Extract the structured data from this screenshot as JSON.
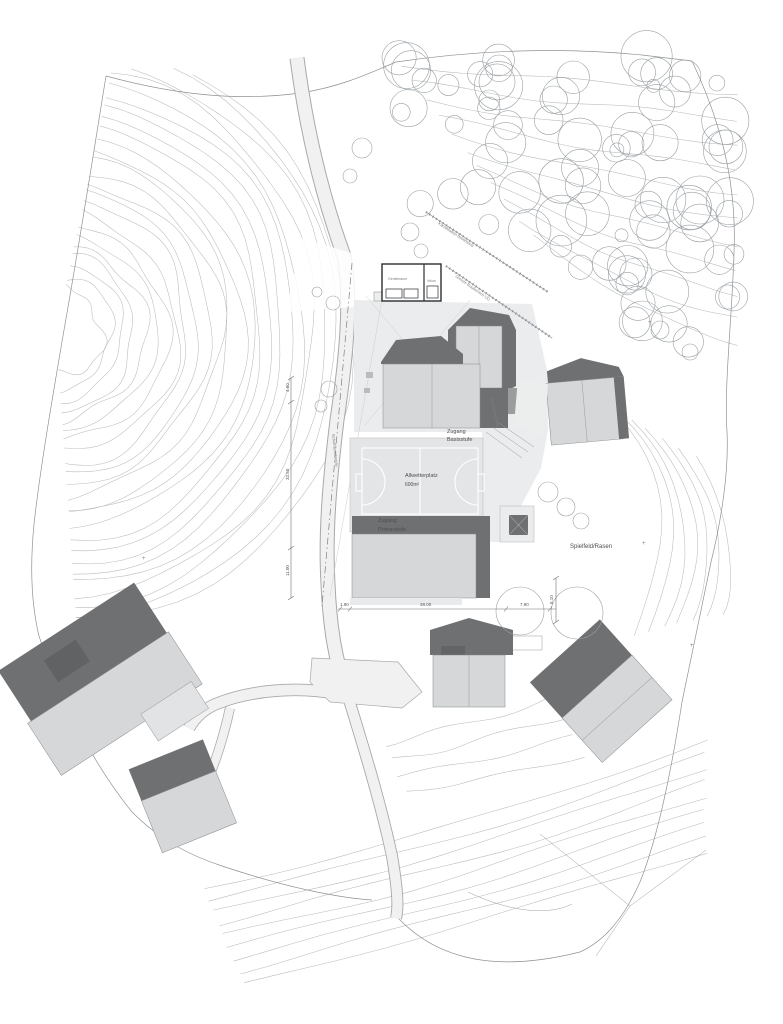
{
  "labels": {
    "access_basisstufe": [
      "Zugang",
      "Basisstufe"
    ],
    "allwetterplatz": [
      "Allwetterplatz",
      "600m²"
    ],
    "access_primarstufe": [
      "Zugang",
      "Primarstufe"
    ],
    "spielfeld": "Spielfeld/Rasen",
    "street": "Schulhausstrasse",
    "utility_line": "Kanalisation bestehend",
    "building_limit": "Grenze Baubereich UG",
    "connecting_path": "Verbindungsweg",
    "shed_rooms": [
      "Geräteraum",
      "Velos"
    ],
    "plus_mark": "+"
  },
  "dimensions": {
    "left": [
      "4.50",
      "32.50",
      "11.00"
    ],
    "bottom": [
      "1.90",
      "38.00",
      "7.90"
    ],
    "right_vertical": "6.10"
  },
  "colors": {
    "building_light": "#d5d7d9",
    "roof_dark": "#6e7072",
    "roof_med": "#9a9c9e",
    "contour": "#b8babc",
    "boundary": "#8e9194",
    "tree": "#9aa0a4",
    "road_fill": "#f1f1f1",
    "road_edge": "#a6a9ab",
    "plaza": "#ebecee",
    "court": "#e4e5e6",
    "text": "#4c4e50"
  }
}
